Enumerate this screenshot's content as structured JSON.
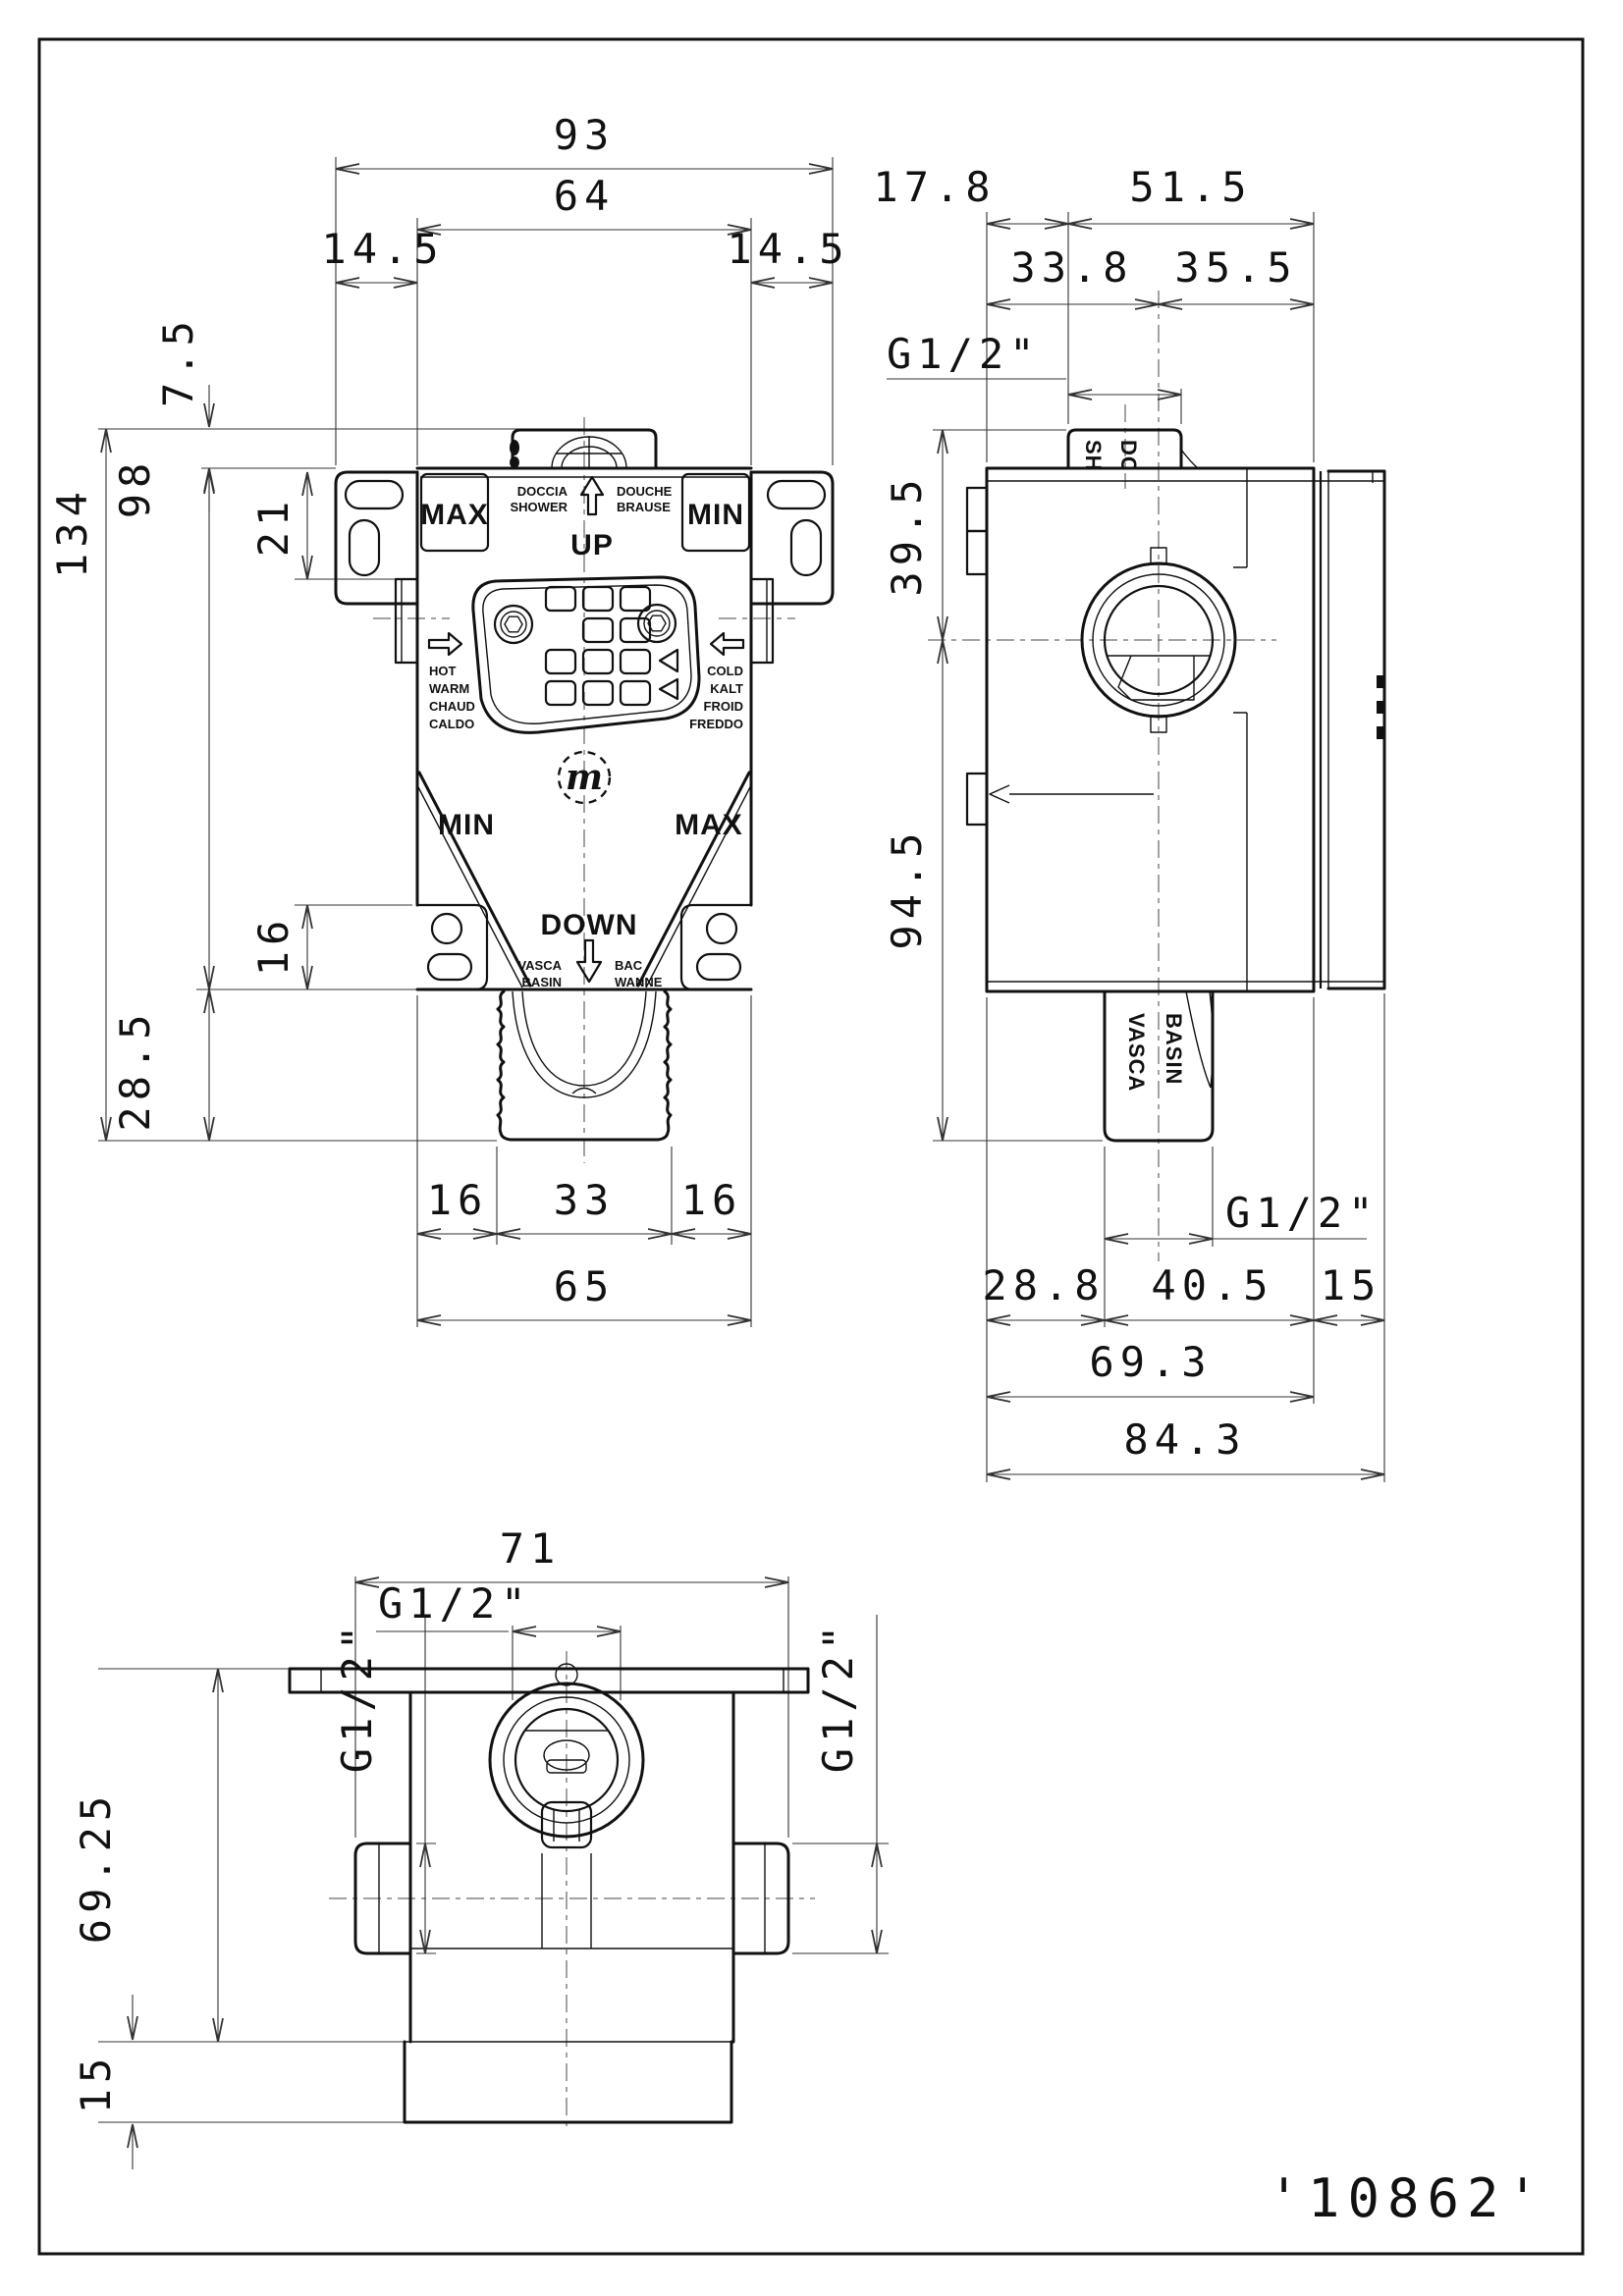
{
  "page": {
    "part_number": "'10862'"
  },
  "front_view": {
    "dims": {
      "total_width": "93",
      "body_width": "64",
      "tab_offset_left": "14.5",
      "tab_offset_right": "14.5",
      "bump_height": "7.5",
      "slot_depth": "21",
      "body_height": "98",
      "total_height": "134",
      "corner_tab_height": "16",
      "outlet_height": "28.5",
      "outlet_left": "16",
      "outlet_width": "33",
      "outlet_right": "16",
      "bottom_width": "65"
    },
    "labels": {
      "max_top_left": "MAX",
      "min_top_right": "MIN",
      "min_bottom_left": "MIN",
      "max_bottom_right": "MAX",
      "up": "UP",
      "down": "DOWN",
      "doccia": "DOCCIA",
      "shower": "SHOWER",
      "douche": "DOUCHE",
      "brause": "BRAUSE",
      "hot": "HOT",
      "warm": "WARM",
      "chaud": "CHAUD",
      "caldo": "CALDO",
      "cold": "COLD",
      "kalt": "KALT",
      "froid": "FROID",
      "freddo": "FREDDO",
      "vasca": "VASCA",
      "basin": "BASIN",
      "bac": "BAC",
      "wanne": "WANNE",
      "logo": "m"
    }
  },
  "side_view": {
    "dims": {
      "front_offset": "17.8",
      "rear_depth": "51.5",
      "port_axis": "33.8",
      "axis_to_wall": "35.5",
      "thread_top": "G1/2\"",
      "thread_bottom": "G1/2\"",
      "top_height": "39.5",
      "bottom_height": "94.5",
      "outlet_offset": "28.8",
      "outlet_to_wall": "40.5",
      "plate_depth": "15",
      "body_depth": "69.3",
      "total_depth": "84.3"
    },
    "labels": {
      "doccia": "DOCCIA",
      "shower": "SHOWER",
      "vasca": "VASCA",
      "basin": "BASIN"
    }
  },
  "bottom_view": {
    "dims": {
      "width": "71",
      "thread_center": "G1/2\"",
      "thread_left": "G1/2\"",
      "thread_right": "G1/2\"",
      "height": "69.25",
      "base_height": "15"
    }
  }
}
